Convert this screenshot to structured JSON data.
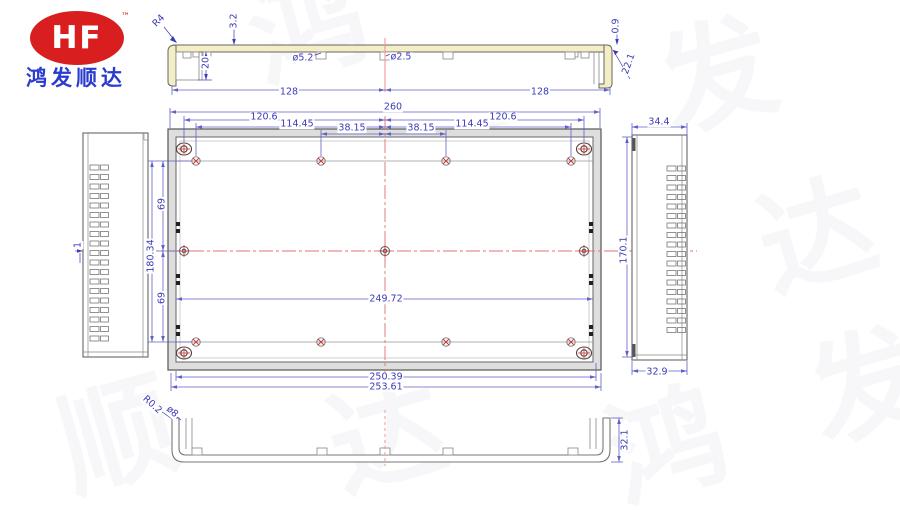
{
  "logo": {
    "brand": "HF",
    "trademark": "™",
    "company": "鸿发顺达"
  },
  "colors": {
    "logo_red": "#d81e1e",
    "company_blue": "#2a3bd0",
    "dimension_blue": "#3a3ab8",
    "centerline_red": "#e07070",
    "profile_yellow": "#f3eec5",
    "line_gray": "#555555"
  },
  "watermark": {
    "text": "鸿发顺达",
    "chars": [
      "鸿",
      "发",
      "顺",
      "达",
      "鸿",
      "发",
      "顺",
      "达",
      "鸿",
      "发"
    ]
  },
  "labels": {
    "top_view": {
      "corner_radius": "R4",
      "thickness": "3.2",
      "depth": "20",
      "hole_left": "ø5.2",
      "hole_center": "ø2.5",
      "lip": "0.9",
      "side_depth": "22.1",
      "half_left": "128",
      "half_right": "128"
    },
    "front_view": {
      "overall_width": "260",
      "left_outer": "120.6",
      "left_mid": "114.45",
      "left_inner": "38.15",
      "right_inner": "38.15",
      "right_mid": "114.45",
      "right_outer": "120.6",
      "upper_half": "69",
      "total_height": "180.34",
      "lower_half": "69",
      "inner_width": "249.72",
      "bottom_width_1": "250.39",
      "bottom_width_2": "253.61"
    },
    "left_view": {
      "wall": "1"
    },
    "right_view": {
      "top_width": "34.4",
      "height": "170.1",
      "bottom_width": "32.9"
    },
    "bottom_view": {
      "corner_radius": "R0.2",
      "hole": "ø8",
      "height": "32.1"
    }
  }
}
